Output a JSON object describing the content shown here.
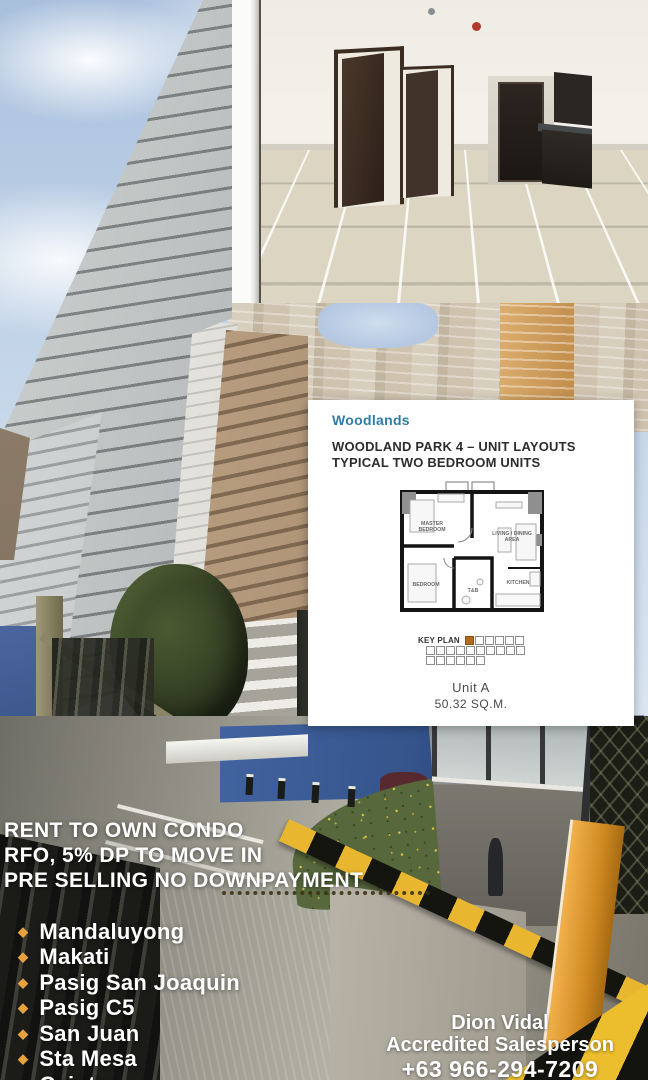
{
  "ad": {
    "headline": [
      "RENT TO OWN CONDO",
      "RFO, 5% DP TO MOVE IN",
      "PRE SELLING NO DOWNPAYMENT"
    ],
    "locations": [
      "Mandaluyong",
      "Makati",
      "Pasig San Joaquin",
      "Pasig C5",
      "San Juan",
      "Sta Mesa",
      "Cainta"
    ],
    "bullet_icon": "diamond-bullet-icon",
    "bullet_color": "#E8A23C",
    "bullet_glyph": "◆",
    "contact": {
      "name": "Dion Vidal",
      "role": "Accredited Salesperson",
      "phone": "+63 966-294-7209"
    }
  },
  "floorplan": {
    "brand": "Woodlands",
    "brand_color": "#2E7EA8",
    "title1": "WOODLAND PARK 4 – UNIT LAYOUTS",
    "title2": "TYPICAL TWO BEDROOM UNITS",
    "rooms": {
      "master1": "MASTER",
      "master2": "BEDROOM",
      "living1": "LIVING / DINING",
      "living2": "AREA",
      "bedroom": "BEDROOM",
      "toilet": "T&B",
      "kitchen": "KITCHEN"
    },
    "key_plan": "KEY PLAN",
    "unit": "Unit A",
    "area": "50.32 SQ.M."
  }
}
